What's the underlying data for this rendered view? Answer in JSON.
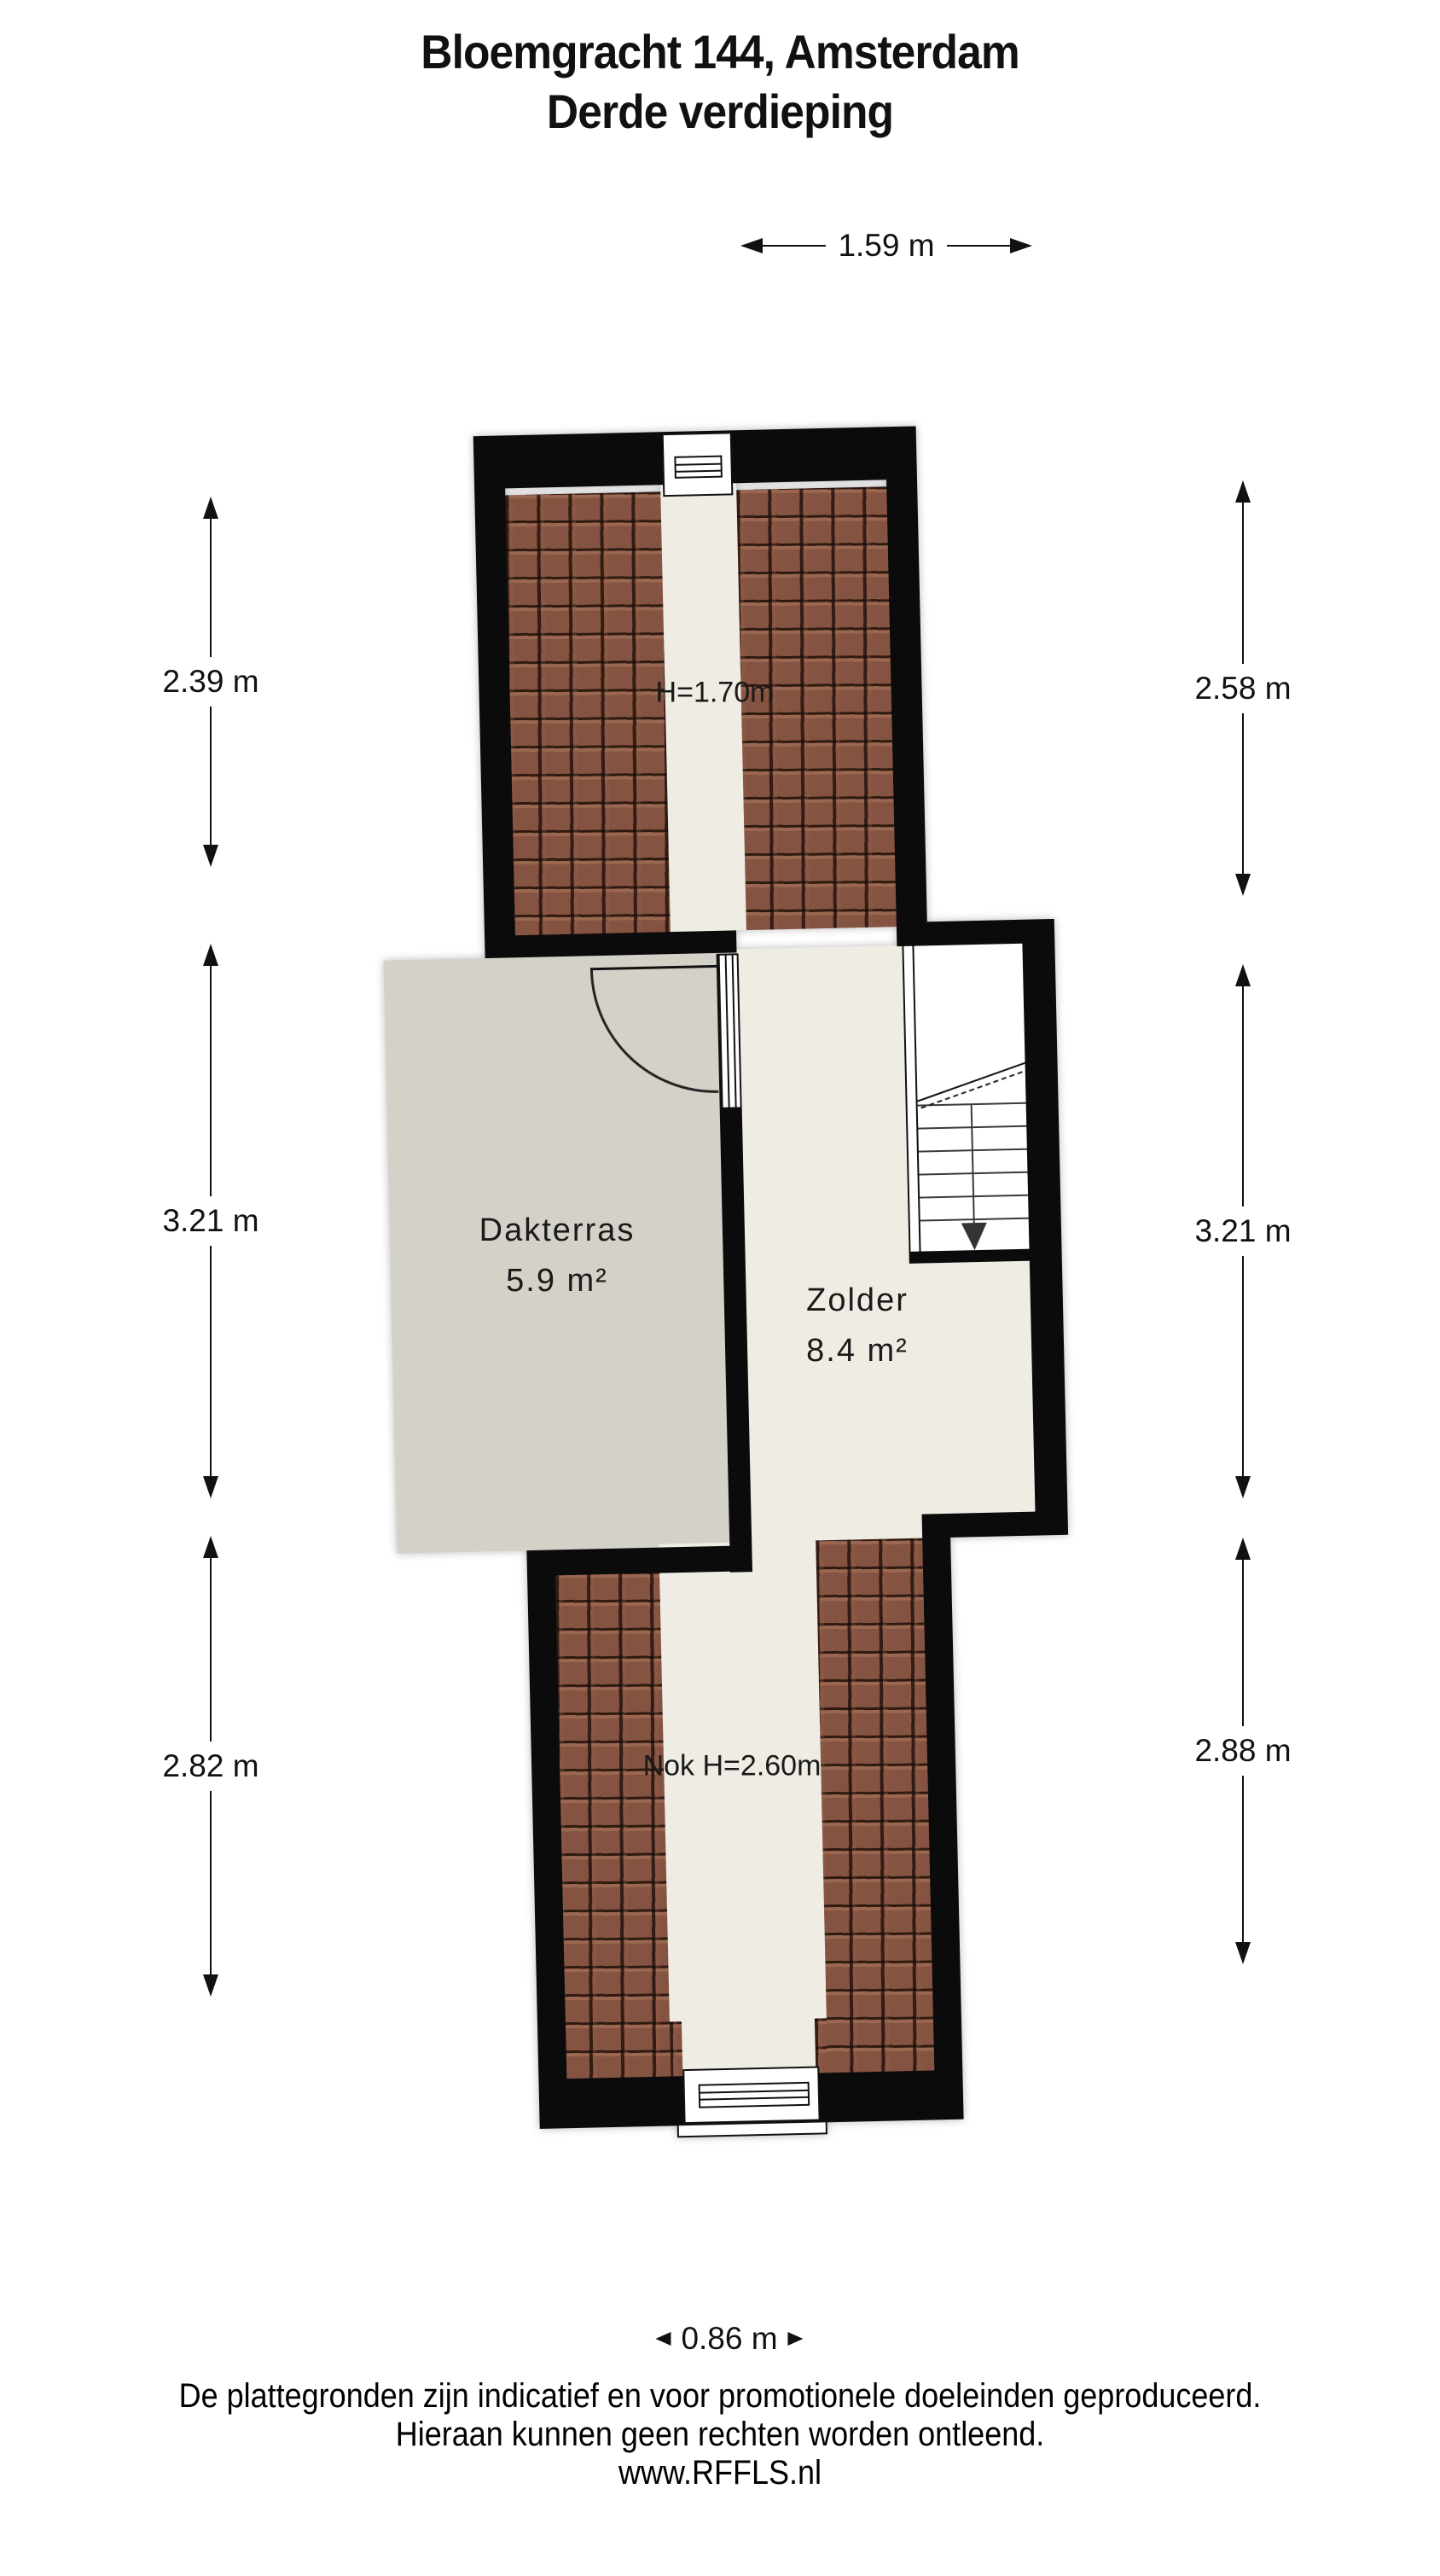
{
  "title": {
    "line1": "Bloemgracht 144, Amsterdam",
    "line2": "Derde verdieping"
  },
  "rooms": [
    {
      "name": "Dakterras",
      "area": "5.9 m²"
    },
    {
      "name": "Zolder",
      "area": "8.4 m²"
    }
  ],
  "annotations": {
    "roof_height": "H=1.70m",
    "ridge_height": "Nok H=2.60m"
  },
  "dimensions": {
    "top": "1.59 m",
    "bottom": "0.86 m",
    "left": [
      "2.39 m",
      "3.21 m",
      "2.82 m"
    ],
    "right": [
      "2.58 m",
      "3.21 m",
      "2.88 m"
    ]
  },
  "footer": {
    "line1": "De plattegronden zijn indicatief en voor promotionele doeleinden geproduceerd.",
    "line2": "Hieraan kunnen geen rechten worden ontleend.",
    "line3": "www.RFFLS.nl"
  },
  "icons": {
    "stairs_direction": "down-arrow"
  },
  "colors": {
    "wall": "#0b0b0b",
    "tile": "#855341",
    "terrace": "#d4d1c8",
    "attic_floor": "#efece4",
    "background": "#ffffff"
  }
}
